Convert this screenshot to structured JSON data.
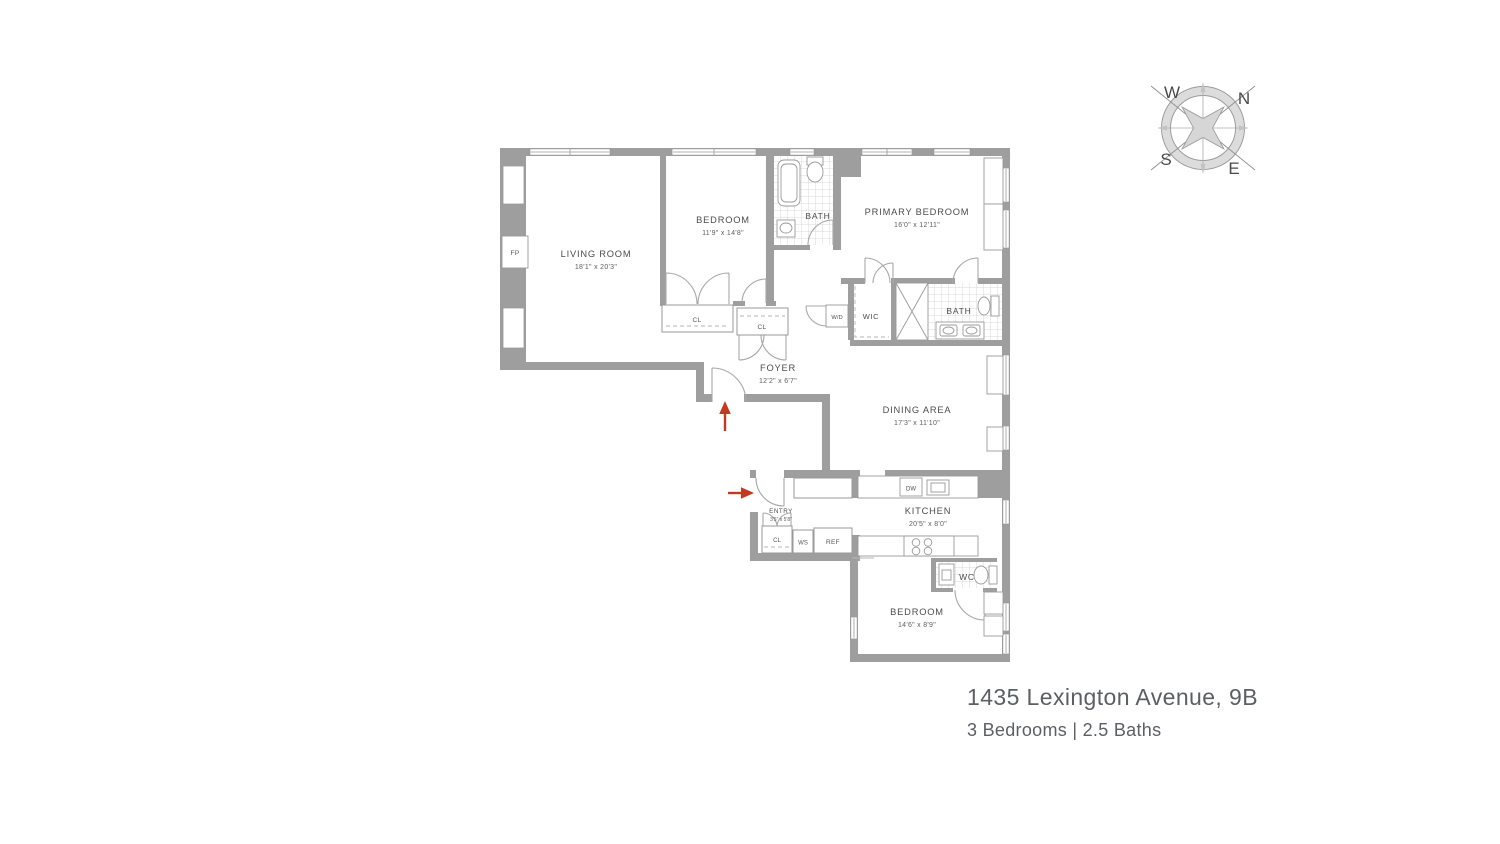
{
  "plan": {
    "rooms": {
      "living_room": {
        "name": "LIVING ROOM",
        "dims": "18'1\" x 20'3\""
      },
      "bedroom_top": {
        "name": "BEDROOM",
        "dims": "11'9\" x 14'8\""
      },
      "bath_top": {
        "name": "BATH"
      },
      "primary_bedroom": {
        "name": "PRIMARY BEDROOM",
        "dims": "16'0\" x 12'11\""
      },
      "washer_dryer": {
        "name": "W/D"
      },
      "wic": {
        "name": "WIC"
      },
      "bath_mid": {
        "name": "BATH"
      },
      "foyer": {
        "name": "FOYER",
        "dims": "12'2\" x 6'7\""
      },
      "dining_area": {
        "name": "DINING AREA",
        "dims": "17'3\" x 11'10\""
      },
      "kitchen": {
        "name": "KITCHEN",
        "dims": "20'5\" x 8'0\""
      },
      "dishwasher": {
        "name": "DW"
      },
      "entry": {
        "name": "ENTRY",
        "dims": "3'5\" x 5'8\""
      },
      "closet_bedroom": {
        "name": "CL"
      },
      "closet_foyer": {
        "name": "CL"
      },
      "closet_entry": {
        "name": "CL"
      },
      "ws": {
        "name": "WS"
      },
      "ref": {
        "name": "REF"
      },
      "wc": {
        "name": "WC"
      },
      "bedroom_bottom": {
        "name": "BEDROOM",
        "dims": "14'6\" x 8'9\""
      },
      "fireplace": {
        "name": "FP"
      }
    },
    "colors": {
      "wall": "#9e9e9e",
      "line": "#9a9a9a",
      "tile": "#d9d9d9",
      "label_text": "#4d4d4d",
      "dim_text": "#5e5e5e",
      "entry_arrow": "#c13a21"
    }
  },
  "compass": {
    "n": "N",
    "e": "E",
    "s": "S",
    "w": "W"
  },
  "title": {
    "address": "1435 Lexington Avenue, 9B",
    "details": "3 Bedrooms | 2.5 Baths"
  }
}
